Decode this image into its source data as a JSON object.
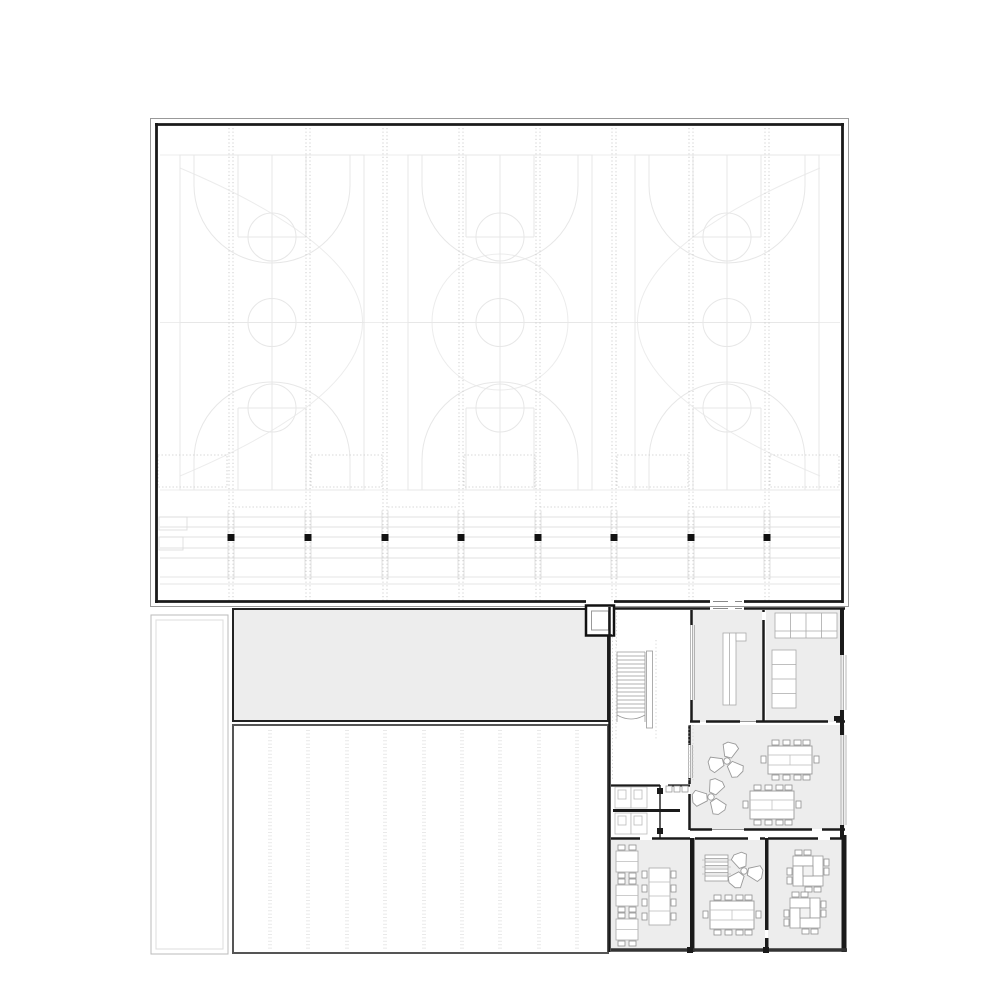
{
  "meta": {
    "type": "architectural-floor-plan",
    "description": "Black-and-white floor plan: large sports hall with three faint basketball courts above a ground-floor wing with stair, lift, changing rooms, WC block and classrooms with tables and chairs"
  },
  "colors": {
    "paper": "#ffffff",
    "wall": "#1a1a1a",
    "wall_gray": "#555555",
    "room_fill": "#ededed",
    "court_line": "#e7e7e7",
    "grid_dot": "#c9c9c9",
    "band_line": "#e0e0e0",
    "furniture_line": "#9a9a9a",
    "stair_line": "#999999"
  },
  "hall": {
    "basketball_courts": 3,
    "structural_columns": 8,
    "grid_lines": 8,
    "door_leaves_to_wing": 2
  },
  "wing": {
    "lift": 1,
    "stair_treads": 18,
    "rooms_gray": 8,
    "wc_stalls": 2,
    "sinks": 3,
    "trefoil_tables": 3,
    "conference_tables": 4,
    "pinwheel_clusters": 2,
    "desk_pairs": 3,
    "long_tables": 1,
    "bench_units": 2,
    "locker_sections": 4,
    "shelf_sections": 4
  }
}
